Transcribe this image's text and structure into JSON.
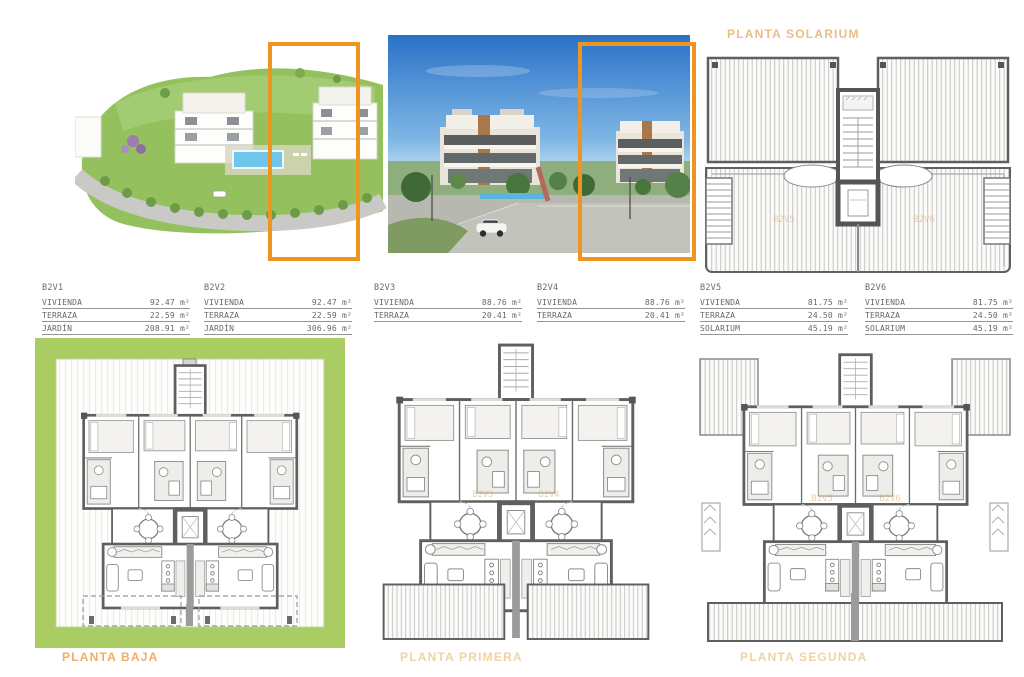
{
  "header": {
    "block_title": "BLOQUE 2",
    "solarium_title": "PLANTA SOLARIUM"
  },
  "colors": {
    "highlight_orange": "#EE9421",
    "title_orange": "#EFA85C",
    "pale_label_orange": "#EFD2A6",
    "garden_green": "#A9CC63",
    "plan_wall_gray": "#5F5F5F",
    "pool_blue": "#6FC6E8",
    "sky_blue": "#2A72C8"
  },
  "unit_tables": [
    {
      "id": "B2V1",
      "rows": [
        {
          "label": "VIVIENDA",
          "value": "92.47 m²"
        },
        {
          "label": "TERRAZA",
          "value": "22.59 m²"
        },
        {
          "label": "JARDÍN",
          "value": "208.91 m²"
        }
      ]
    },
    {
      "id": "B2V2",
      "rows": [
        {
          "label": "VIVIENDA",
          "value": "92.47 m²"
        },
        {
          "label": "TERRAZA",
          "value": "22.59 m²"
        },
        {
          "label": "JARDÍN",
          "value": "306.96 m²"
        }
      ]
    },
    {
      "id": "B2V3",
      "rows": [
        {
          "label": "VIVIENDA",
          "value": "88.76 m²"
        },
        {
          "label": "TERRAZA",
          "value": "20.41 m²"
        }
      ]
    },
    {
      "id": "B2V4",
      "rows": [
        {
          "label": "VIVIENDA",
          "value": "88.76 m²"
        },
        {
          "label": "TERRAZA",
          "value": "20.41 m²"
        }
      ]
    },
    {
      "id": "B2V5",
      "rows": [
        {
          "label": "VIVIENDA",
          "value": "81.75 m²"
        },
        {
          "label": "TERRAZA",
          "value": "24.50 m²"
        },
        {
          "label": "SOLARIUM",
          "value": "45.19 m²"
        }
      ]
    },
    {
      "id": "B2V6",
      "rows": [
        {
          "label": "VIVIENDA",
          "value": "81.75 m²"
        },
        {
          "label": "TERRAZA",
          "value": "24.50 m²"
        },
        {
          "label": "SOLARIUM",
          "value": "45.19 m²"
        }
      ]
    }
  ],
  "floor_labels": {
    "baja": "PLANTA BAJA",
    "primera": "PLANTA PRIMERA",
    "segunda": "PLANTA SEGUNDA"
  },
  "plan_unit_labels": {
    "primera": [
      "B2V3",
      "B2V4"
    ],
    "segunda": [
      "B2V5",
      "B2V6"
    ],
    "solarium": [
      "B2V5",
      "B2V6"
    ]
  }
}
